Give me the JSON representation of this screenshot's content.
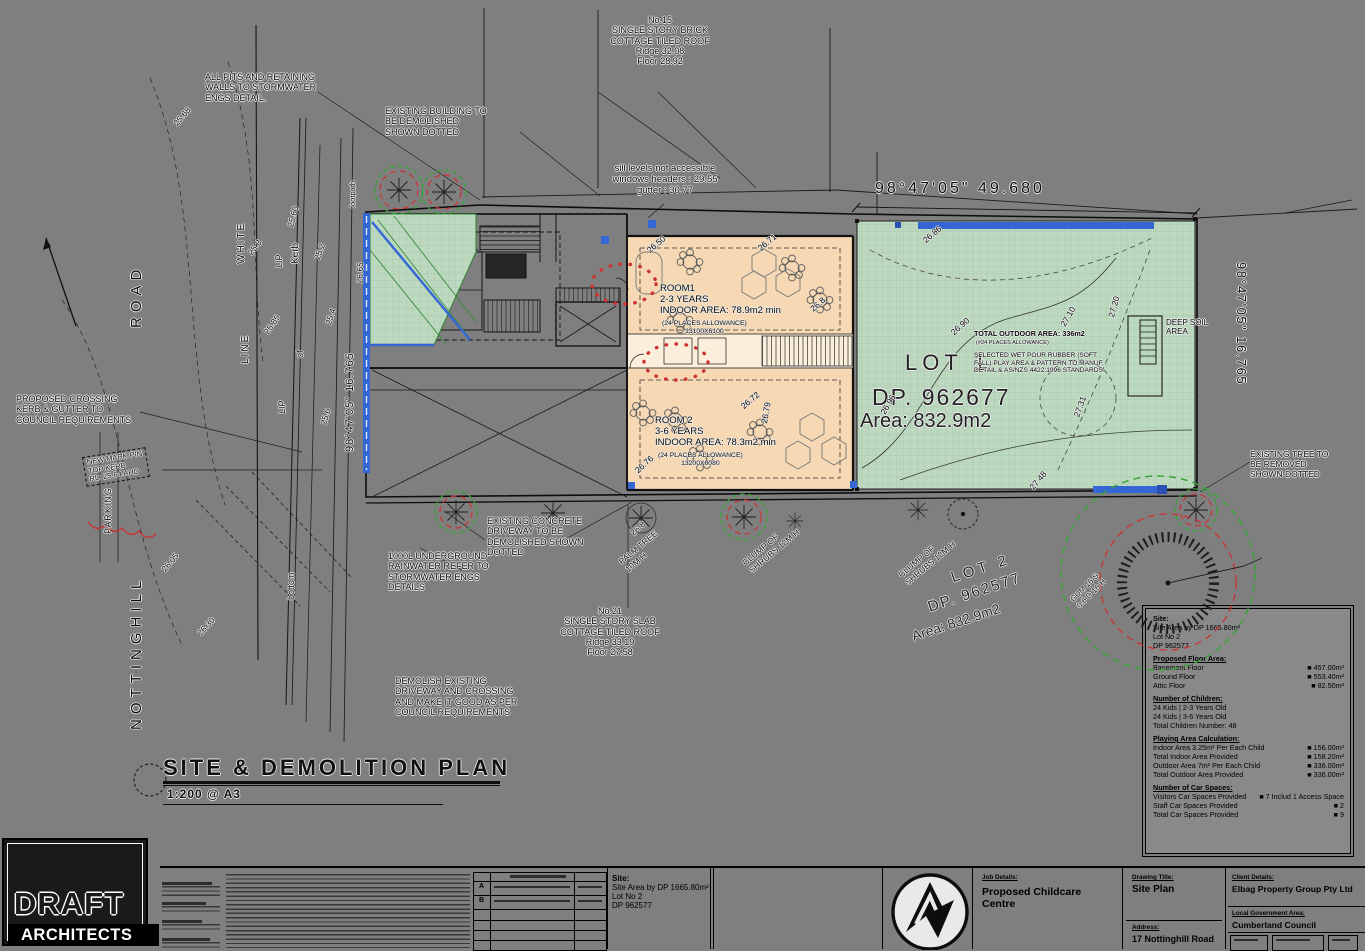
{
  "colors": {
    "paper_gray": "#7f7f7f",
    "outdoor_green": "#bcd9c0",
    "rooms_orange": "#f6d9b4",
    "highlight_blue": "#3566d6",
    "demolish_red": "#cc3333",
    "tree_green": "#3aa43a",
    "logo_accent_orange": "#e8912d"
  },
  "plan_title": {
    "text": "SITE & DEMOLITION PLAN",
    "scale": "1:200 @ A3"
  },
  "dims": {
    "top": "98°47'05\"  49.680",
    "right": "98°47'05\"  16.765",
    "left": "98°47'05\"  16.765"
  },
  "lots": {
    "lot1": {
      "lot": "LOT 1",
      "dp": "DP. 962677",
      "area": "Area: 832.9m2"
    },
    "lot2": {
      "lot": "LOT 2",
      "dp": "DP. 962577",
      "area": "Area: 832.9m2"
    }
  },
  "neighbours": {
    "no15": "No.15\nSINGLE STORY BRICK\nCOTTAGE TILED ROOF\nRidge 32.08\nFloor 28.92",
    "no21": "No.21\nSINGLE STORY SLAB\nCOTTAGE TILED ROOF\nRidge 33.19\nFloor 27.58"
  },
  "notes": {
    "pits": "ALL PITS AND RETAINING\nWALLS TO STORMWATER\nENGS DETAIL.",
    "demolished_building": "EXISTING BUILDING TO\nBE DEMOLISHED\nSHOWN DOTTED",
    "sill": "sill levels not accessible\nwindows headers : 29.55\ngutter : 30.77",
    "crossing": "PROPOSED CROSSING\nKERB & GUTTER TO\nCOUNCIL REQUIREMENTS",
    "pin": "NEW MARK PIN\nTOP KERB\nRL: 25.64 AHD",
    "driveway": "EXISTING CONCRETE\nDRIVEWAY TO BE\nDEMOLISHED SHOWN\nDOTTED",
    "tank": "1000L UNDERGROUND\nRAINWATER REFER TO\nSTORMWATER ENGS\nDETAILS",
    "demolish_driveway": "DEMOLISH EXISTING\nDRIVEWAY AND CROSSING\nAND MAKE IT GOOD AS PER\nCOUNCIL REQUIREMENTS",
    "tree_removed": "EXISTING TREE TO\nBE REMOVED\nSHOWN DOTTED",
    "outdoor_title": "TOTAL OUTDOOR AREA: 336m2",
    "outdoor_sub": "(#24 PLACES ALLOWANCE)",
    "outdoor_spec": "SELECTED WET POUR RUBBER (SOFT\nFALL) PLAY AREA & PATTERN TO MANUF.\nDETAIL & AS/NZS 4422:1996 STANDARDS",
    "deep_soil": "DEEP SOIL\nAREA"
  },
  "rooms": {
    "room1": {
      "main": "ROOM1\n2-3 YEARS\nINDOOR AREA: 78.9m2 min",
      "sub": "(24 PLACES ALLOWANCE)\n13100X6100"
    },
    "room2": {
      "main": "ROOM 2\n3-6 YEARS\nINDOOR AREA: 78.3m2 min",
      "sub": "(24 PLACES ALLOWANCE)\n13200X6080"
    }
  },
  "landscape": {
    "palm": "PALM TREE\n10M H",
    "shrubs1": "CLUMP OF\nSHRUBS 12M H",
    "shrubs2": "CLUMP OF\nSHRUBS 12M H",
    "gum": "GUM 16 S\n0.6 D 16 H"
  },
  "road": {
    "name1": "NOTTINGHILL",
    "name2": "ROAD",
    "white": "WHITE",
    "line": "LINE",
    "kerb": "Kerb",
    "lip1": "LIP",
    "lip2": "LIP",
    "of": "of",
    "bottom": "bottom",
    "parking": "PARKING",
    "footpath": "footpath"
  },
  "plan": {
    "spot_levels": [
      "25.68",
      "25.8",
      "25.60",
      "25.2",
      "25.85",
      "25.4",
      "25.6",
      "26.05",
      "26.30",
      "26.65",
      "26.50",
      "26.71",
      "26.8",
      "26.72",
      "26.79",
      "26.76",
      "26.8",
      "26.90",
      "26.96",
      "27.10",
      "27.20",
      "27.31",
      "26.86",
      "27.48"
    ]
  },
  "legend": {
    "site": {
      "heading": "Site:",
      "lines": [
        "Site Area by DP 1665.80m²",
        "Lot No 2",
        "DP 962577"
      ]
    },
    "floor": {
      "heading": "Proposed Floor Area:",
      "rows": [
        {
          "label": "Basement Floor",
          "value": "■ 457.00m²"
        },
        {
          "label": "Ground Floor",
          "value": "■ 553.40m²"
        },
        {
          "label": "Attic Floor",
          "value": "■ 82.50m²"
        }
      ]
    },
    "children": {
      "heading": "Number of Children:",
      "lines": [
        "24 Kids | 2-3 Years Old",
        "24 Kids | 3-6 Years Old",
        "Total Children Number: 48"
      ]
    },
    "playing": {
      "heading": "Playing Area Calculation:",
      "rows": [
        {
          "label": "Indoor Area 3.25m² Per Each Child",
          "value": "■ 156.00m²"
        },
        {
          "label": "Total Indoor Area Provided",
          "value": "■ 158.20m²"
        },
        {
          "label": "Outdoor Area 7m² Per Each Child",
          "value": "■ 336.00m²"
        },
        {
          "label": "Total Outdoor Area Provided",
          "value": "■ 336.00m²"
        }
      ]
    },
    "cars": {
      "heading": "Number of Car Spaces:",
      "rows": [
        {
          "label": "Visitors Car Spaces Provided",
          "value": "■ 7 Includ 1 Access Space"
        },
        {
          "label": "Staff Car Spaces Provided",
          "value": "■ 2"
        },
        {
          "label": "Total Car Spaces Provided",
          "value": "■ 9"
        }
      ]
    }
  },
  "title_block": {
    "firm": {
      "name_top": "DRAFT",
      "name_bottom": "ARCHITECTS"
    },
    "amendments": {
      "issues": [
        "A",
        "B"
      ]
    },
    "site": {
      "heading": "Site:",
      "lines": [
        "Site Area by DP 1665.80m²",
        "Lot No 2",
        "DP 962577"
      ]
    },
    "project": {
      "label": "Job Details:",
      "value": "Proposed Childcare\nCentre"
    },
    "drawing": {
      "label": "Drawing Title:",
      "value": "Site Plan"
    },
    "address": {
      "label": "Address:",
      "value": "17 Nottinghill Road"
    },
    "client": {
      "label": "Client Details:",
      "value": "Elbag Property Group Pty Ltd"
    },
    "lga": {
      "label": "Local Government Area:",
      "value": "Cumberland Council"
    }
  }
}
